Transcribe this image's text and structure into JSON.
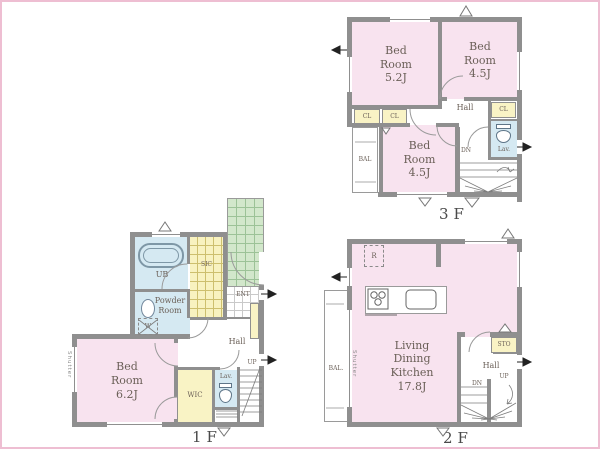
{
  "colors": {
    "room_pink": "#f8e3ef",
    "closet_yellow": "#f9f3c5",
    "water_blue": "#d5e9f2",
    "tile_green": "#d2e7cb",
    "wall_gray": "#8f8f8f",
    "frame_pink": "#eebed2",
    "label_text": "#6a5f57"
  },
  "floors": {
    "f1": {
      "label": "1F",
      "bed": "Bed\nRoom\n6.2J",
      "ub": "UB",
      "powder": "Powder\nRoom",
      "washer": "W",
      "sic": "SIC",
      "ent": "ENT",
      "hall": "Hall",
      "wic": "WIC",
      "lav": "Lav.",
      "up": "UP",
      "shutter": "Shutter"
    },
    "f2": {
      "label": "2F",
      "ldk": "Living\nDining\nKitchen\n17.8J",
      "bal": "BAL.",
      "shutter": "Shutter",
      "sto": "STO",
      "hall": "Hall",
      "up": "UP",
      "dn": "DN",
      "fridge": "R"
    },
    "f3": {
      "label": "3F",
      "bed1": "Bed\nRoom\n5.2J",
      "bed2": "Bed\nRoom\n4.5J",
      "bed3": "Bed\nRoom\n4.5J",
      "cl": "CL",
      "hall": "Hall",
      "lav": "Lav.",
      "bal": "BAL",
      "dn": "DN"
    }
  }
}
